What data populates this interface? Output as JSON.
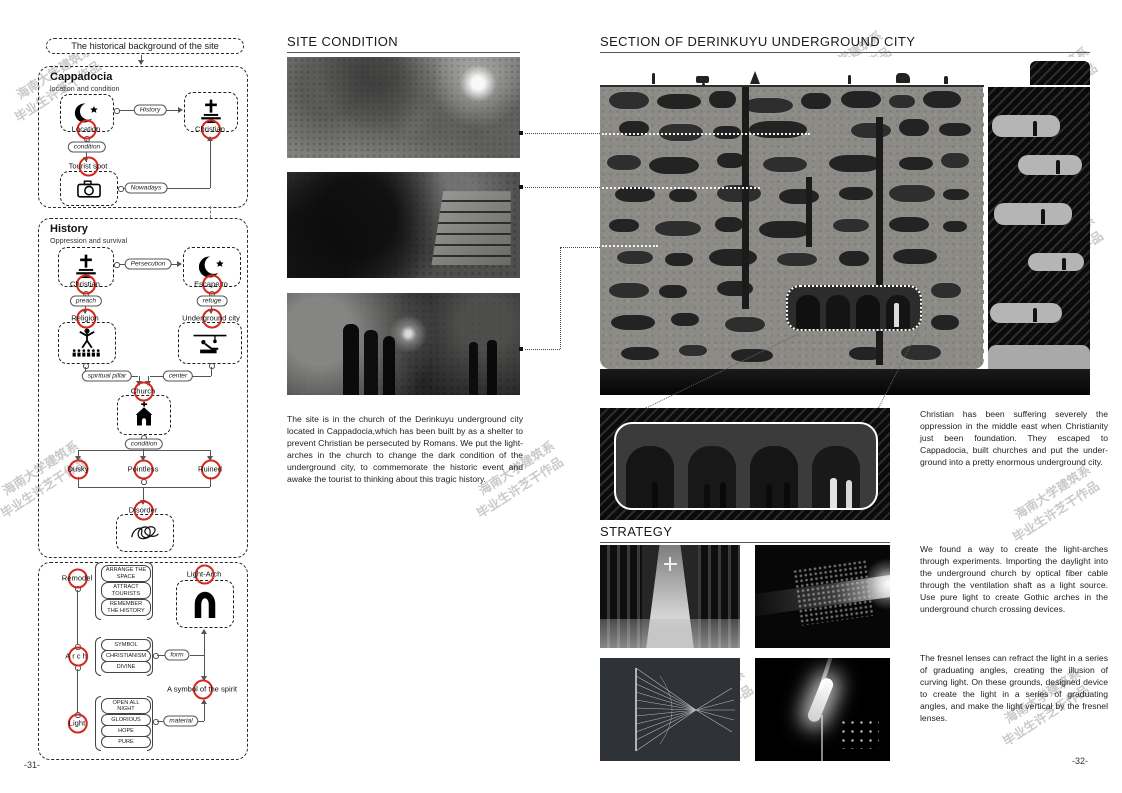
{
  "accent_red": "#d5281e",
  "watermark": {
    "line1": "海南大学建筑系",
    "line2": "毕业生许芝干作品"
  },
  "icons": {
    "crescent_star": "☪",
    "cross_altar": "✝",
    "camera": "camera-shape",
    "preacher": "figure-with-crowd",
    "underground_city": "cave-room-lines",
    "church": "church-shape",
    "scribble": "tangle-lines",
    "arch": "∩"
  },
  "page_left": {
    "page_number": "-31-",
    "title": "The historical background of the site",
    "cappadocia": {
      "heading": "Cappadocia",
      "subheading": "location and condition",
      "location": "Location",
      "christian": "Christian",
      "tourist_spot": "Tourist spot",
      "edge_history": "History",
      "edge_condition": "condition",
      "edge_nowadays": "Nowadays"
    },
    "history": {
      "heading": "History",
      "subheading": "Oppression and survival",
      "christian": "Christian",
      "escape_to": "Escape to",
      "religion": "Religion",
      "underground_city": "Underground city",
      "church": "Church",
      "dusky": "Dusky",
      "pointless": "Pointless",
      "ruined": "Ruined",
      "disorder": "Disorder",
      "edge_persecution": "Persecution",
      "edge_preach": "preach",
      "edge_refuge": "refuge",
      "edge_spiritual_pillar": "spiritual pillar",
      "edge_center": "center",
      "edge_condition": "condition"
    },
    "concept": {
      "remodel": "Remodel",
      "arch": "Arch",
      "light": "Light",
      "light_arch": "Light-Arch",
      "symbol": "A symbol of the spirit",
      "edge_form": "form",
      "edge_material": "material",
      "remodel_list": [
        "ARRANGE THE SPACE",
        "ATTRACT TOURISTS",
        "REMEMBER THE HISTORY"
      ],
      "arch_list": [
        "SYMBOL",
        "CHRISTIANISM",
        "DIVINE"
      ],
      "light_list": [
        "OPEN ALL NIGHT",
        "GLORIOUS",
        "HOPE",
        "PURE"
      ]
    }
  },
  "middle": {
    "title": "SITE CONDITION",
    "paragraph": "The site is in the church of the Derinkuyu underground city located in Cappadocia,which has been built by as a shelter to prevent Christian be persecuted by Romans. We put the light-arches in the church to change the dark condition of the underground city, to commemorate the historic event and awake the tourist to thinking about this tragic history."
  },
  "page_right": {
    "page_number": "-32-",
    "section_title": "SECTION OF DERINKUYU UNDERGROUND CITY",
    "strategy_title": "STRATEGY",
    "paragraph_history": "Christian has been suffering severely the oppression in the middle east when Christianity just been foundation. They escaped to Cappadocia, built churches and put the under-ground into a pretty enormous underground city.",
    "paragraph_strategy_1": "We found a way to create the light-arches through experiments. Importing the daylight into the underground church by optical fiber cable through the ventilation shaft as a light source. Use pure light to create Gothic arches in the underground church crossing devices.",
    "paragraph_strategy_2": "The fresnel lenses can refract the light in a series of graduating angles, creating the illusion of curving light. On these grounds, designed device to create the light in a series of graduating angles, and make the light vertical by the fresnel lenses."
  }
}
